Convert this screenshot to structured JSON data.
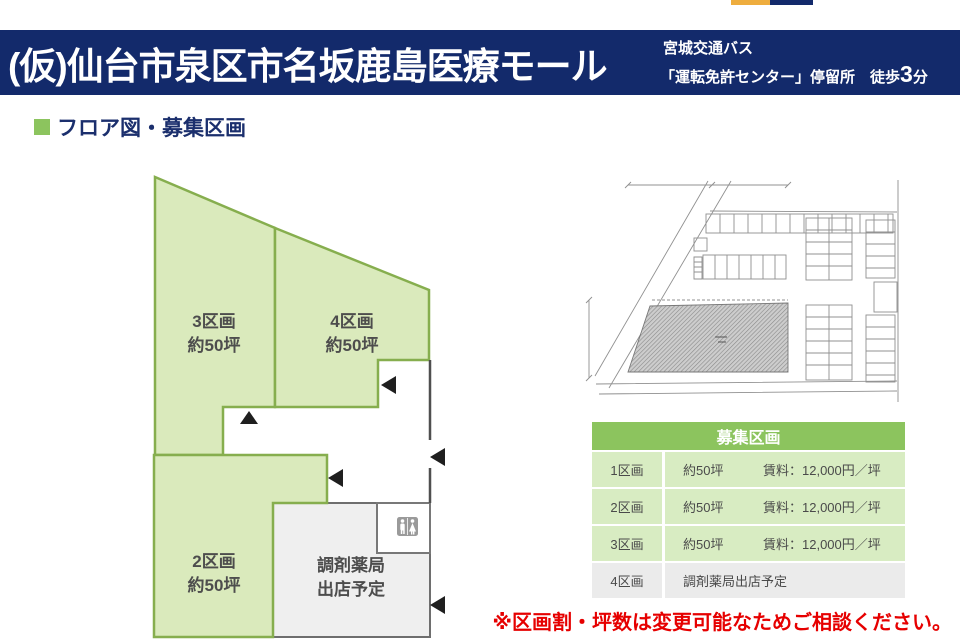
{
  "brand": {
    "orange_color": "#eead3e",
    "navy_color": "#132a6b"
  },
  "header": {
    "bg_color": "#132a6b",
    "title": "(仮)仙台市泉区市名坂鹿島医療モール",
    "access_line1": "宮城交通バス",
    "access_line2_prefix": "「運転免許センター」停留所　徒歩",
    "access_line2_number": "3",
    "access_line2_suffix": "分"
  },
  "section": {
    "heading": "フロア図・募集区画",
    "bullet_color": "#8cc45e"
  },
  "floorplan": {
    "fill_color": "#daeabc",
    "stroke_color": "#86ae4e",
    "pharmacy_fill": "#efefef",
    "units": {
      "u3": {
        "name": "3区画",
        "size": "約50坪"
      },
      "u4": {
        "name": "4区画",
        "size": "約50坪"
      },
      "u2": {
        "name": "2区画",
        "size": "約50坪"
      },
      "pharmacy": {
        "line1": "調剤薬局",
        "line2": "出店予定"
      }
    },
    "icons": {
      "restroom": "restroom-icon",
      "entrance_arrows": "entrance-arrow"
    }
  },
  "table": {
    "title": "募集区画",
    "header_bg": "#8cc45e",
    "row_bg": "#d8ecc2",
    "row_alt_bg": "#ebebeb",
    "rows": [
      {
        "name": "1区画",
        "size": "約50坪",
        "rent": "賃料：12,000円／坪"
      },
      {
        "name": "2区画",
        "size": "約50坪",
        "rent": "賃料：12,000円／坪"
      },
      {
        "name": "3区画",
        "size": "約50坪",
        "rent": "賃料：12,000円／坪"
      },
      {
        "name": "4区画",
        "size": "調剤薬局出店予定",
        "rent": ""
      }
    ]
  },
  "note": {
    "text": "※区画割・坪数は変更可能なためご相談ください。",
    "color": "#e60000"
  }
}
